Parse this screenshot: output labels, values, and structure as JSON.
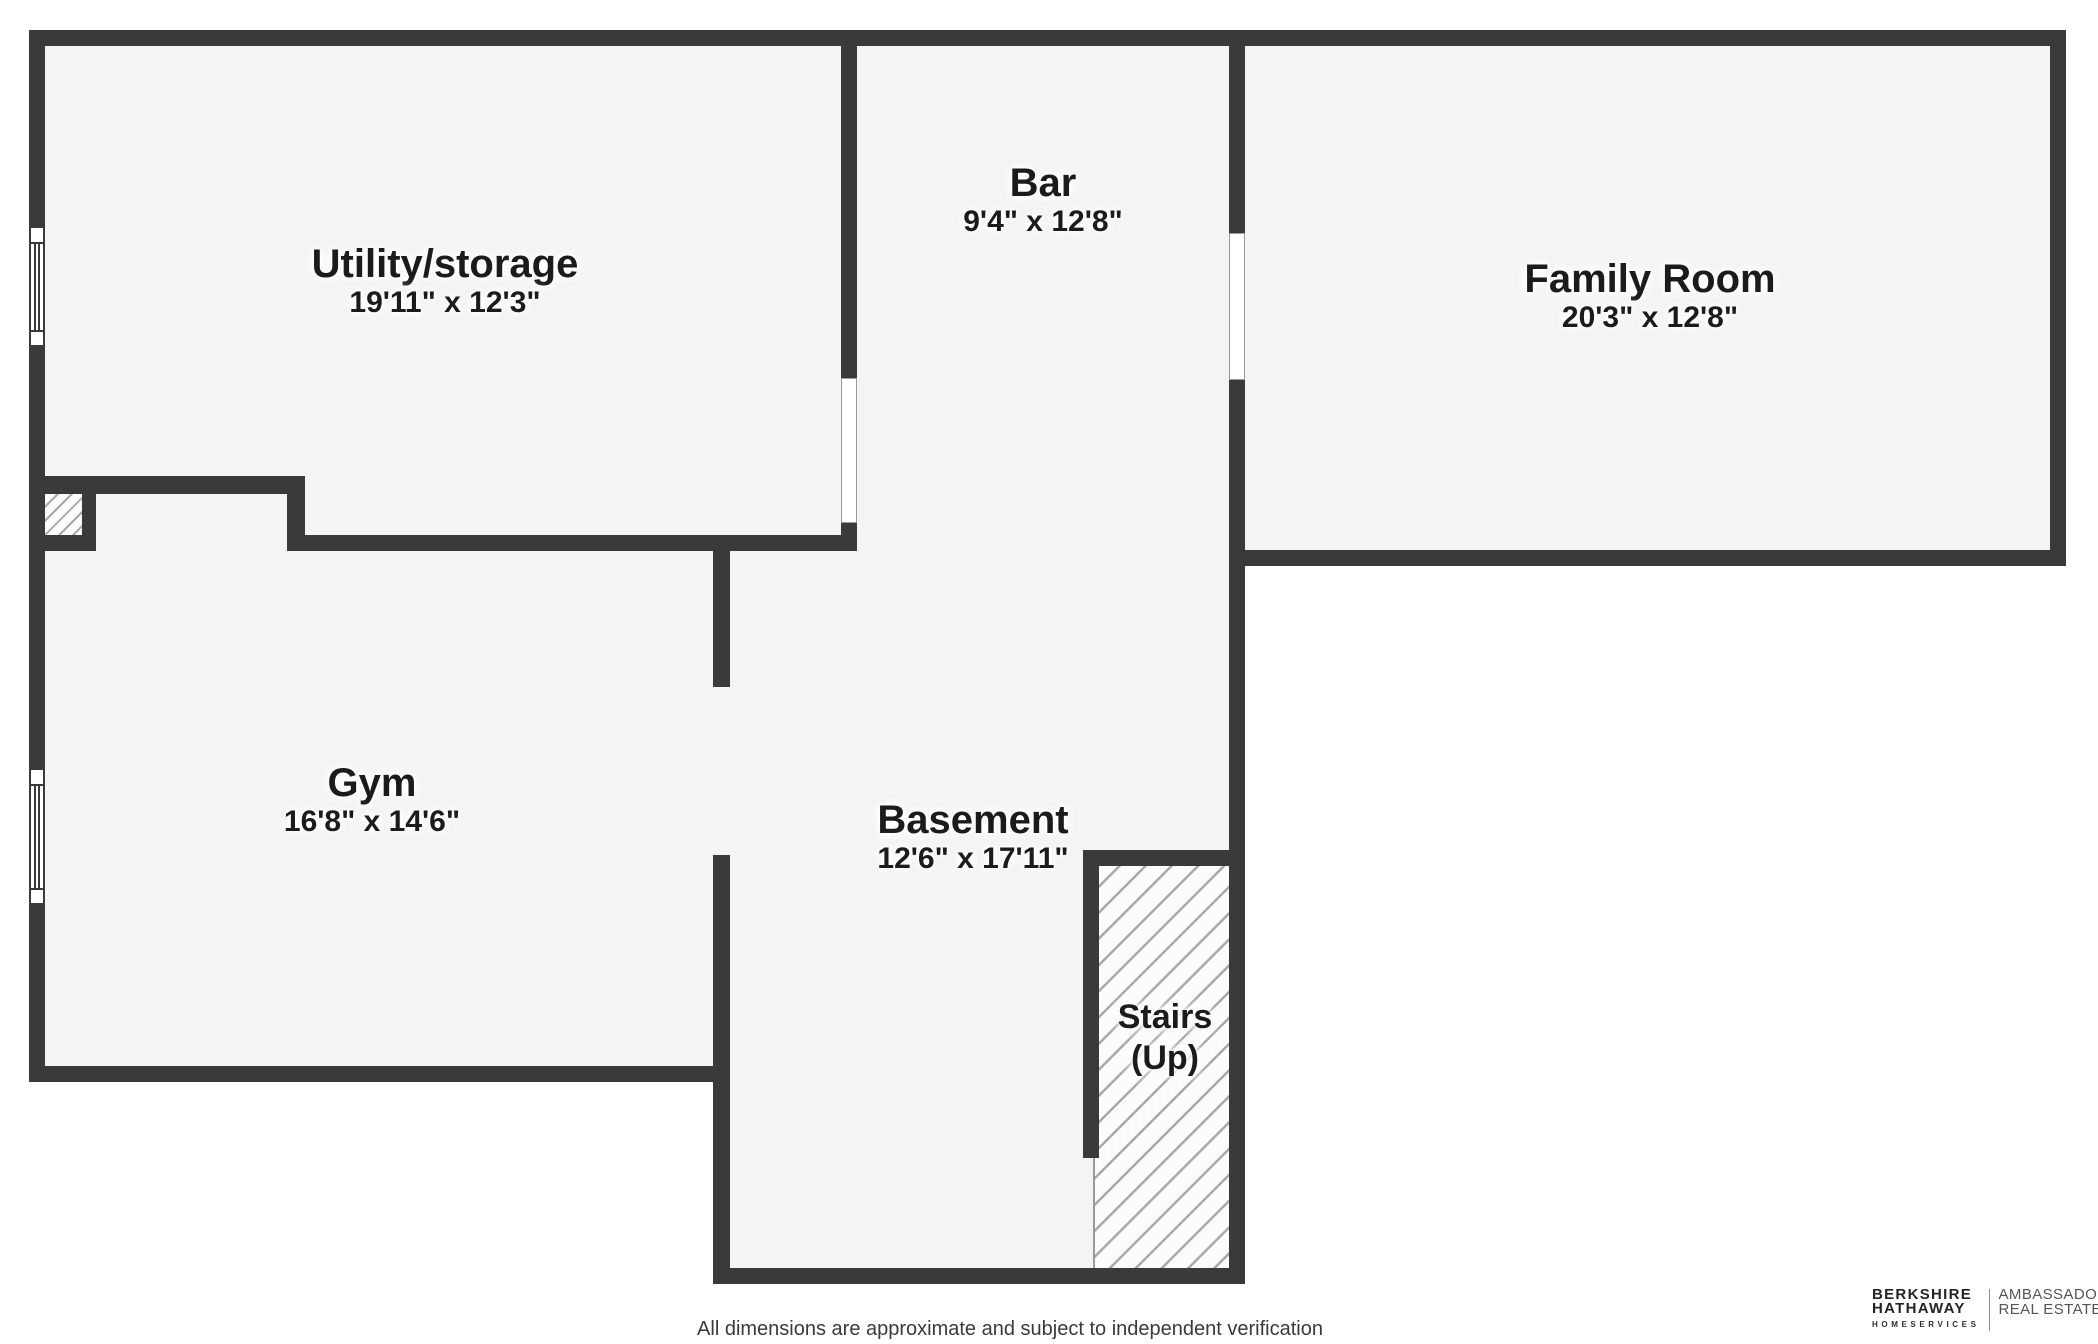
{
  "plan": {
    "rooms": [
      {
        "name": "Utility/storage",
        "dims": "19'11\" x 12'3\""
      },
      {
        "name": "Bar",
        "dims": "9'4\" x 12'8\""
      },
      {
        "name": "Family Room",
        "dims": "20'3\" x 12'8\""
      },
      {
        "name": "Gym",
        "dims": "16'8\" x 14'6\""
      },
      {
        "name": "Basement",
        "dims": "12'6\" x 17'11\""
      }
    ],
    "stairs_label": {
      "line1": "Stairs",
      "line2": "(Up)"
    }
  },
  "footer": {
    "disclaimer": "All dimensions are approximate and subject to independent verification"
  },
  "brand": {
    "name_line1": "BERKSHIRE",
    "name_line2": "HATHAWAY",
    "name_line3": "HOMESERVICES",
    "division_line1": "AMBASSADOR",
    "division_line2": "REAL ESTATE"
  },
  "colors": {
    "wall": "#3a3a3c",
    "floor": "#f4f4f4",
    "hatch_line": "#a9a9a9",
    "label_text": "#1b1b1b"
  }
}
